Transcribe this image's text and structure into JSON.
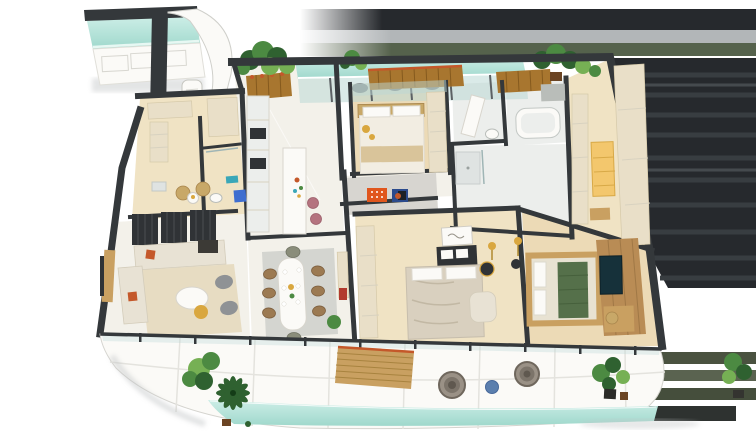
{
  "scene": {
    "type": "3d-isometric-floorplan-render",
    "rooms": [
      {
        "name": "plunge-pool-deck"
      },
      {
        "name": "upper-terrace-lap-pool"
      },
      {
        "name": "entry-foyer"
      },
      {
        "name": "pantry"
      },
      {
        "name": "guest-bathroom"
      },
      {
        "name": "tea-corner"
      },
      {
        "name": "living-room"
      },
      {
        "name": "dining-room"
      },
      {
        "name": "kitchen"
      },
      {
        "name": "hallway"
      },
      {
        "name": "bedroom-3"
      },
      {
        "name": "bathroom-2"
      },
      {
        "name": "shower-room"
      },
      {
        "name": "walk-in-wardrobe"
      },
      {
        "name": "bedroom-2"
      },
      {
        "name": "master-bedroom"
      },
      {
        "name": "wrap-around-balcony"
      },
      {
        "name": "balcony-lap-pool"
      }
    ],
    "features": [
      "l-shaped-cream-sofa",
      "slatted-screen-panels",
      "oval-dining-table-with-8-chairs",
      "kitchen-island-with-pink-bar-stools",
      "freestanding-bathtub",
      "glowing-wardrobe",
      "green-tufted-master-bed",
      "tv-media-wall",
      "timber-slat-daybed",
      "wicker-lounge-chairs",
      "potted-plants",
      "orange-and-blue-wall-art",
      "framed-script-artwork",
      "curved-white-feature-wall"
    ]
  },
  "palette": {
    "background": "#ffffff",
    "wall": "#34383b",
    "wallFace": "#d7d5d0",
    "floor": "#f3f1ea",
    "floorWarm": "#f0e3c4",
    "floorWood": "#ecdab6",
    "floorBath": "#eceeec",
    "cabinetCream": "#e9dfc8",
    "white": "#fbfaf7",
    "poolLight": "#cdeee7",
    "poolDeep": "#9fd8cc",
    "glass": "#bcd8d6",
    "plantDark": "#2f6130",
    "plant": "#4c8a42",
    "plantLight": "#76b054",
    "plantPot": "#6b4423",
    "woodSlat": "#a8762f",
    "slatLine": "#855a1e",
    "orangeAccent": "#c4582a",
    "artOrange": "#e0561d",
    "artBlue": "#2b4a8c",
    "sofa": "#e8e2d4",
    "rug": "#e7dcc2",
    "chairBrown": "#9c7a52",
    "stoolPink": "#b4737f",
    "bedGreen": "#55704a",
    "darkFurniture": "#303336",
    "gold": "#d9a73f",
    "grayFurniture": "#8f9295",
    "rattan": "#c8a868",
    "wicker": "#9a9186",
    "pouf": "#5b7fae",
    "blueBin": "#3f6ed0",
    "tealAccent": "#3aa7b8",
    "woodFurniture": "#c9a061",
    "woodPanel": "#b98c55",
    "tvScreen": "#16313a",
    "marblePad": "#b9beb9",
    "throwTan": "#d9c49a",
    "backdropDark": "#26292d",
    "backdropStreak": "#383d41",
    "backdropGray": "#b2b6b8",
    "backdropGreen": "#55624c",
    "olive1": "#4a5240",
    "olive2": "#5a6350",
    "olive3": "#454e3c",
    "oliveDark": "#2e3230",
    "shadow": "#c3c6c7",
    "red": "#b23a2e",
    "amber": "#f3c76d"
  }
}
